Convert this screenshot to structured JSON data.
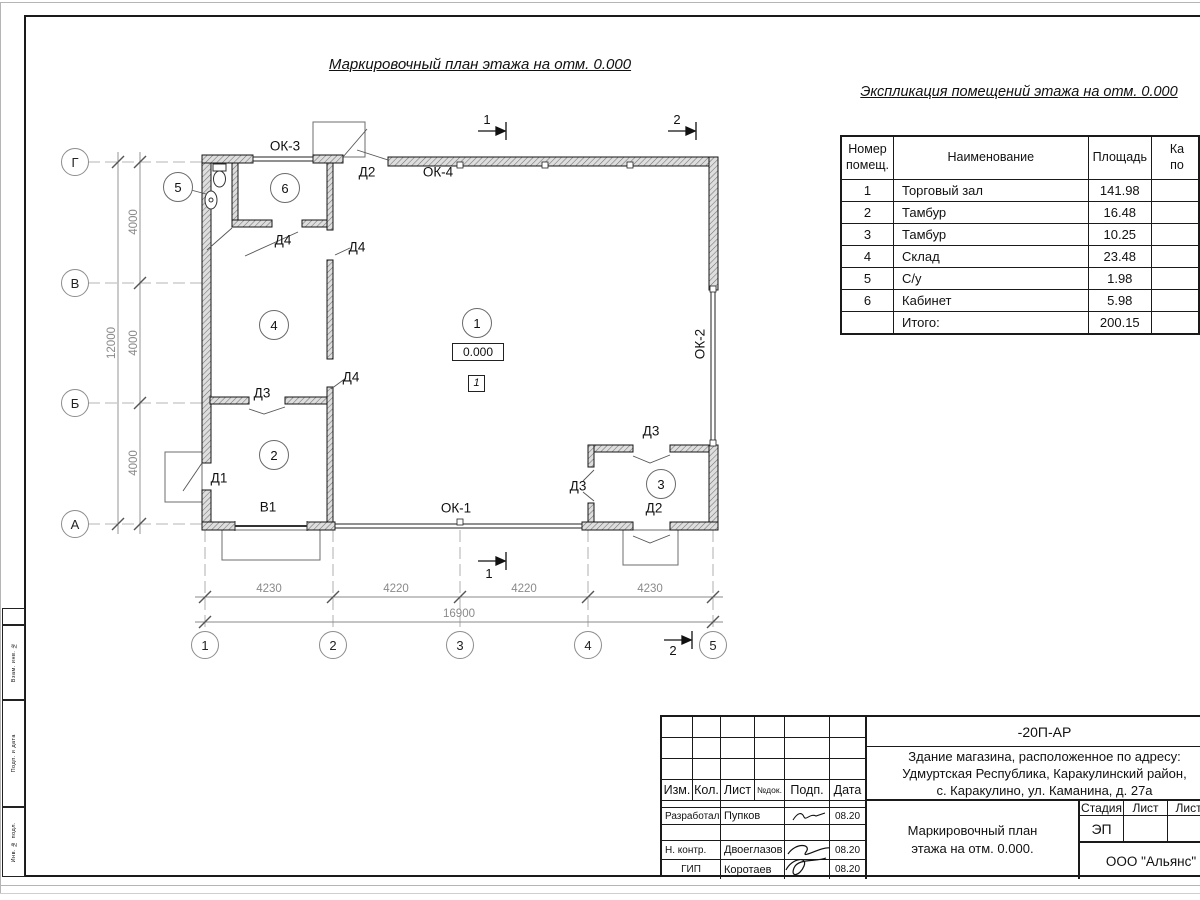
{
  "plan": {
    "title": "Маркировочный план этажа на отм. 0.000",
    "elevation": "0.000",
    "floor_mark": "1",
    "rooms": [
      {
        "n": "1",
        "x": 477,
        "y": 323
      },
      {
        "n": "2",
        "x": 274,
        "y": 455
      },
      {
        "n": "3",
        "x": 661,
        "y": 484
      },
      {
        "n": "4",
        "x": 274,
        "y": 325
      },
      {
        "n": "5",
        "x": 178,
        "y": 187
      },
      {
        "n": "6",
        "x": 285,
        "y": 188
      }
    ],
    "labels": [
      {
        "t": "ОК-3",
        "x": 285,
        "y": 146
      },
      {
        "t": "Д2",
        "x": 367,
        "y": 172
      },
      {
        "t": "ОК-4",
        "x": 438,
        "y": 172
      },
      {
        "t": "Д4",
        "x": 283,
        "y": 240
      },
      {
        "t": "Д4",
        "x": 357,
        "y": 247
      },
      {
        "t": "Д4",
        "x": 351,
        "y": 377
      },
      {
        "t": "Д3",
        "x": 262,
        "y": 393
      },
      {
        "t": "Д1",
        "x": 219,
        "y": 478
      },
      {
        "t": "В1",
        "x": 268,
        "y": 507
      },
      {
        "t": "ОК-1",
        "x": 456,
        "y": 508
      },
      {
        "t": "Д3",
        "x": 651,
        "y": 431
      },
      {
        "t": "Д3",
        "x": 578,
        "y": 486
      },
      {
        "t": "Д2",
        "x": 654,
        "y": 508
      },
      {
        "t": "ОК-2",
        "x": 700,
        "y": 344,
        "rot": true
      }
    ],
    "axes_left": [
      {
        "n": "Г",
        "y": 162
      },
      {
        "n": "В",
        "y": 283
      },
      {
        "n": "Б",
        "y": 403
      },
      {
        "n": "А",
        "y": 524
      }
    ],
    "axes_bottom": [
      {
        "n": "1",
        "x": 205
      },
      {
        "n": "2",
        "x": 333
      },
      {
        "n": "3",
        "x": 460
      },
      {
        "n": "4",
        "x": 588
      },
      {
        "n": "5",
        "x": 713
      }
    ],
    "dims_bottom": [
      {
        "v": "4230",
        "x": 269
      },
      {
        "v": "4220",
        "x": 396
      },
      {
        "v": "4220",
        "x": 524
      },
      {
        "v": "4230",
        "x": 650
      }
    ],
    "dim_total_bottom": {
      "v": "16900",
      "x": 459
    },
    "dims_left": [
      {
        "v": "4000",
        "y": 222
      },
      {
        "v": "4000",
        "y": 343
      },
      {
        "v": "4000",
        "y": 463
      }
    ],
    "dim_total_left": {
      "v": "12000",
      "x": 112,
      "y": 343
    },
    "sections": [
      {
        "n": "1",
        "x": 487,
        "y": 112
      },
      {
        "n": "2",
        "x": 677,
        "y": 112
      },
      {
        "n": "1",
        "x": 489,
        "y": 566
      },
      {
        "n": "2",
        "x": 673,
        "y": 643
      }
    ]
  },
  "explication": {
    "title": "Экспликация помещений этажа на отм. 0.000",
    "col_num": "Номер\nпомещ.",
    "col_name": "Наименование",
    "col_area": "Площадь",
    "col_cut": "Ка\nпо",
    "rows": [
      {
        "num": "1",
        "name": "Торговый зал",
        "area": "141.98"
      },
      {
        "num": "2",
        "name": "Тамбур",
        "area": "16.48"
      },
      {
        "num": "3",
        "name": "Тамбур",
        "area": "10.25"
      },
      {
        "num": "4",
        "name": "Склад",
        "area": "23.48"
      },
      {
        "num": "5",
        "name": "С/у",
        "area": "1.98"
      },
      {
        "num": "6",
        "name": "Кабинет",
        "area": "5.98"
      },
      {
        "num": "",
        "name": "Итого:",
        "area": "200.15"
      }
    ]
  },
  "titleblock": {
    "doc_number": "-20П-АР",
    "address": "Здание магазина, расположенное по адресу:\nУдмуртская Республика, Каракулинский район,\nс. Каракулино, ул. Каманина, д. 27а",
    "cols": [
      "Изм.",
      "Кол.",
      "Лист",
      "№док.",
      "Подп.",
      "Дата"
    ],
    "people": [
      {
        "role": "Разработал",
        "name": "Пупков",
        "date": "08.20"
      },
      {
        "role": "Н. контр.",
        "name": "Двоеглазов",
        "date": "08.20"
      },
      {
        "role": "ГИП",
        "name": "Коротаев",
        "date": "08.20"
      }
    ],
    "stage_label": "Стадия",
    "sheet_label": "Лист",
    "sheets_label": "Листов",
    "stage": "ЭП",
    "sheet_title": "Маркировочный план\nэтажа на отм. 0.000.",
    "company": "ООО \"Альянс\""
  },
  "margin_stamp": {
    "labels": [
      "Взам. инв. №",
      "Подп. и дата",
      "Инв. № подл."
    ]
  }
}
